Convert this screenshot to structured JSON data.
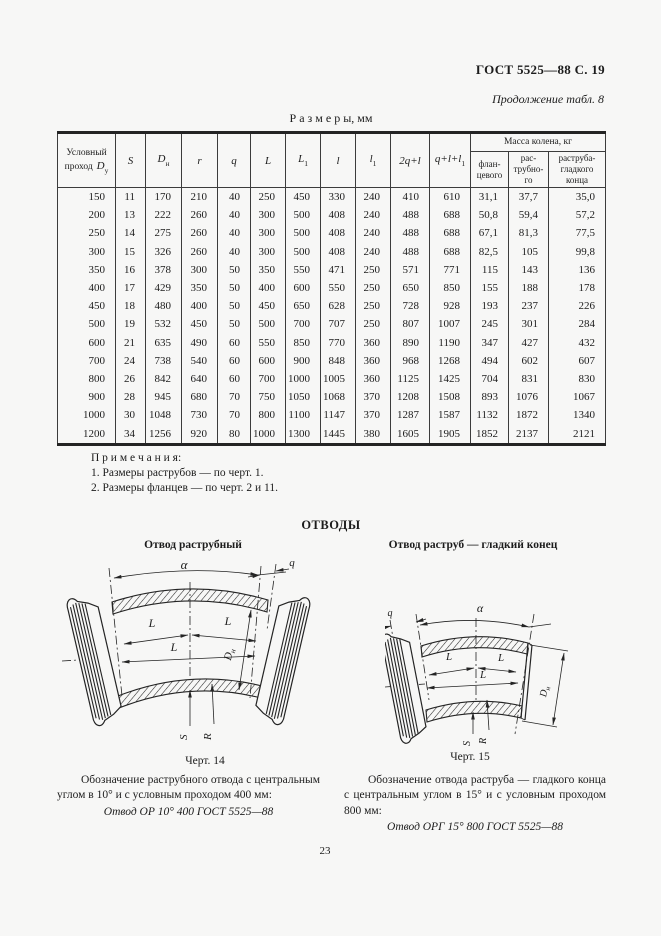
{
  "page": {
    "gost_header": "ГОСТ 5525—88 С. 19",
    "continuation": "Продолжение табл. 8",
    "table_title": "Р а з м е р ы,  мм",
    "page_number": "23"
  },
  "table": {
    "mass_group": "Масса колена, кг",
    "columns": [
      {
        "label": "Условный проход",
        "symbol": "D",
        "sub": "у"
      },
      {
        "symbol": "S"
      },
      {
        "symbol": "D",
        "sub": "н"
      },
      {
        "symbol": "r"
      },
      {
        "symbol": "q"
      },
      {
        "symbol": "L"
      },
      {
        "symbol": "L",
        "sub": "1"
      },
      {
        "symbol": "l"
      },
      {
        "symbol": "l",
        "sub": "1"
      },
      {
        "symbol": "2q+l"
      },
      {
        "symbol": "q+l+l",
        "sub": "1"
      },
      {
        "label": "флан-цевого"
      },
      {
        "label": "рас-трубно-го"
      },
      {
        "label": "раструба-гладкого конца"
      }
    ],
    "rows": [
      [
        "150",
        "11",
        "170",
        "210",
        "40",
        "250",
        "450",
        "330",
        "240",
        "410",
        "610",
        "31,1",
        "37,7",
        "35,0"
      ],
      [
        "200",
        "13",
        "222",
        "260",
        "40",
        "300",
        "500",
        "408",
        "240",
        "488",
        "688",
        "50,8",
        "59,4",
        "57,2"
      ],
      [
        "250",
        "14",
        "275",
        "260",
        "40",
        "300",
        "500",
        "408",
        "240",
        "488",
        "688",
        "67,1",
        "81,3",
        "77,5"
      ],
      [
        "300",
        "15",
        "326",
        "260",
        "40",
        "300",
        "500",
        "408",
        "240",
        "488",
        "688",
        "82,5",
        "105",
        "99,8"
      ],
      [
        "350",
        "16",
        "378",
        "300",
        "50",
        "350",
        "550",
        "471",
        "250",
        "571",
        "771",
        "115",
        "143",
        "136"
      ],
      [
        "400",
        "17",
        "429",
        "350",
        "50",
        "400",
        "600",
        "550",
        "250",
        "650",
        "850",
        "155",
        "188",
        "178"
      ],
      [
        "450",
        "18",
        "480",
        "400",
        "50",
        "450",
        "650",
        "628",
        "250",
        "728",
        "928",
        "193",
        "237",
        "226"
      ],
      [
        "500",
        "19",
        "532",
        "450",
        "50",
        "500",
        "700",
        "707",
        "250",
        "807",
        "1007",
        "245",
        "301",
        "284"
      ],
      [
        "600",
        "21",
        "635",
        "490",
        "60",
        "550",
        "850",
        "770",
        "360",
        "890",
        "1190",
        "347",
        "427",
        "432"
      ],
      [
        "700",
        "24",
        "738",
        "540",
        "60",
        "600",
        "900",
        "848",
        "360",
        "968",
        "1268",
        "494",
        "602",
        "607"
      ],
      [
        "800",
        "26",
        "842",
        "640",
        "60",
        "700",
        "1000",
        "1005",
        "360",
        "1125",
        "1425",
        "704",
        "831",
        "830"
      ],
      [
        "900",
        "28",
        "945",
        "680",
        "70",
        "750",
        "1050",
        "1068",
        "370",
        "1208",
        "1508",
        "893",
        "1076",
        "1067"
      ],
      [
        "1000",
        "30",
        "1048",
        "730",
        "70",
        "800",
        "1100",
        "1147",
        "370",
        "1287",
        "1587",
        "1132",
        "1872",
        "1340"
      ],
      [
        "1200",
        "34",
        "1256",
        "920",
        "80",
        "1000",
        "1300",
        "1445",
        "380",
        "1605",
        "1905",
        "1852",
        "2137",
        "2121"
      ]
    ]
  },
  "notes": {
    "title": "П р и м е ч а н и я:",
    "items": [
      "1. Размеры раструбов — по черт. 1.",
      "2. Размеры фланцев — по черт. 2 и 11."
    ]
  },
  "figures": {
    "section_title": "ОТВОДЫ",
    "left": {
      "subtitle": "Отвод раструбный",
      "caption": "Черт. 14"
    },
    "right": {
      "subtitle": "Отвод раструб — гладкий конец",
      "caption": "Черт. 15"
    },
    "labels": {
      "alpha": "α",
      "q": "q",
      "L": "L",
      "D": "D",
      "D_sub": "н",
      "S": "S",
      "R": "R"
    }
  },
  "paragraphs": {
    "left_text": "Обозначение раструбного отвода с центральным углом в 10° и с условным проходом 400 мм:",
    "left_designation": "Отвод ОР 10° 400 ГОСТ 5525—88",
    "right_text": "Обозначение отвода раструба — гладкого конца с центральным углом в 15° и с условным проходом 800 мм:",
    "right_designation": "Отвод ОРГ 15° 800 ГОСТ 5525—88"
  }
}
